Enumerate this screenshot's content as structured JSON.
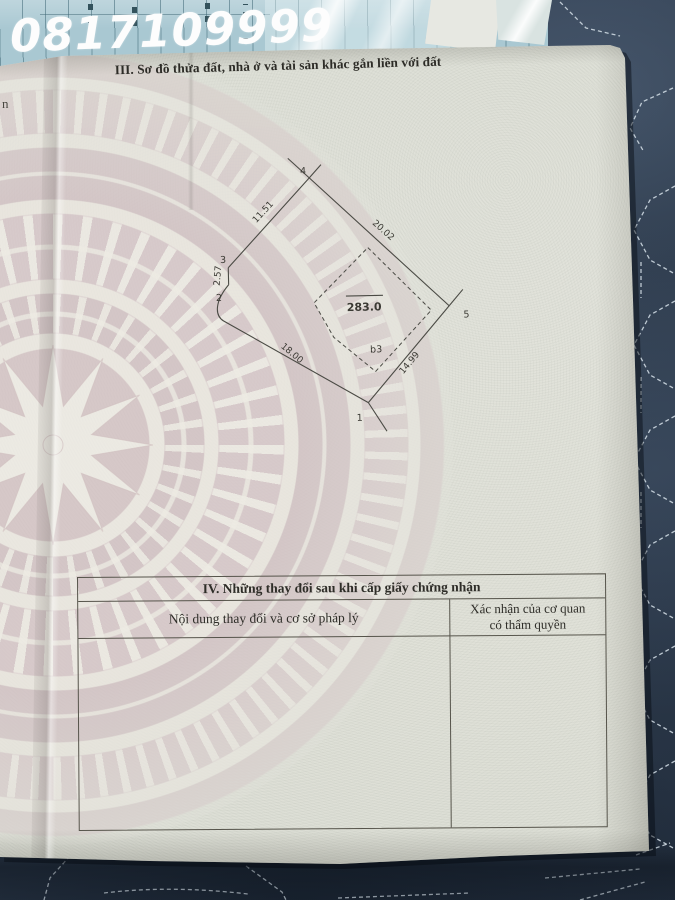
{
  "overlay": {
    "phone": "0817109999"
  },
  "document": {
    "section3_title": "III. Sơ đồ thửa đất, nhà ở và tài sản khác gắn liền với đất",
    "left_page_fragment": "n",
    "compass_label": "B",
    "diagram": {
      "area_label": "283.0",
      "building_label": "b3",
      "vertices": {
        "v1": "1",
        "v2": "2",
        "v3": "3",
        "v4": "4",
        "v5": "5"
      },
      "dims": {
        "d12": "18.00",
        "d23": "2.57",
        "d34": "11.51",
        "d45": "20.02",
        "d51": "14.99"
      }
    },
    "section4": {
      "title": "IV. Những thay đổi sau khi cấp giấy chứng nhận",
      "col1": "Nội dung thay đổi và cơ sở pháp lý",
      "col2_line1": "Xác nhận của cơ quan",
      "col2_line2": "có thẩm quyền"
    }
  },
  "colors": {
    "fabric_navy": "#2f3b4d",
    "stitch_white": "#d7e2ea",
    "paper": "#e0e1d9",
    "drum_pink": "#d5c4c7",
    "blue_doc": "#a9c8d2",
    "ink": "#3b3a34",
    "phone_white": "#fdfdfd"
  }
}
